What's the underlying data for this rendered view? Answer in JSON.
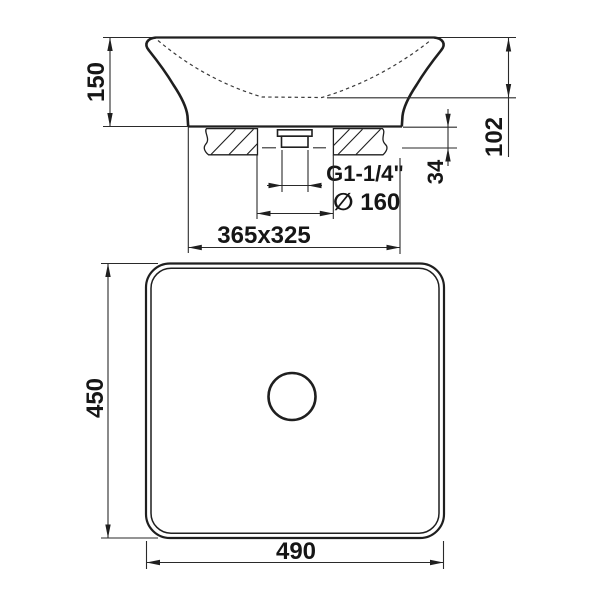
{
  "colors": {
    "line": "#1f1f1f",
    "thin_line": "#2a2a2a",
    "hidden_line": "#3a3a3a",
    "text": "#161616",
    "background": "#ffffff"
  },
  "side_view": {
    "height_label": "150",
    "basin_depth_label": "102",
    "mounting_thickness_label": "34",
    "drain_thread_label": "G1-1/4\"",
    "hole_diameter_label": "∅ 160",
    "base_footprint_label": "365x325"
  },
  "top_view": {
    "depth_label": "450",
    "width_label": "490"
  }
}
